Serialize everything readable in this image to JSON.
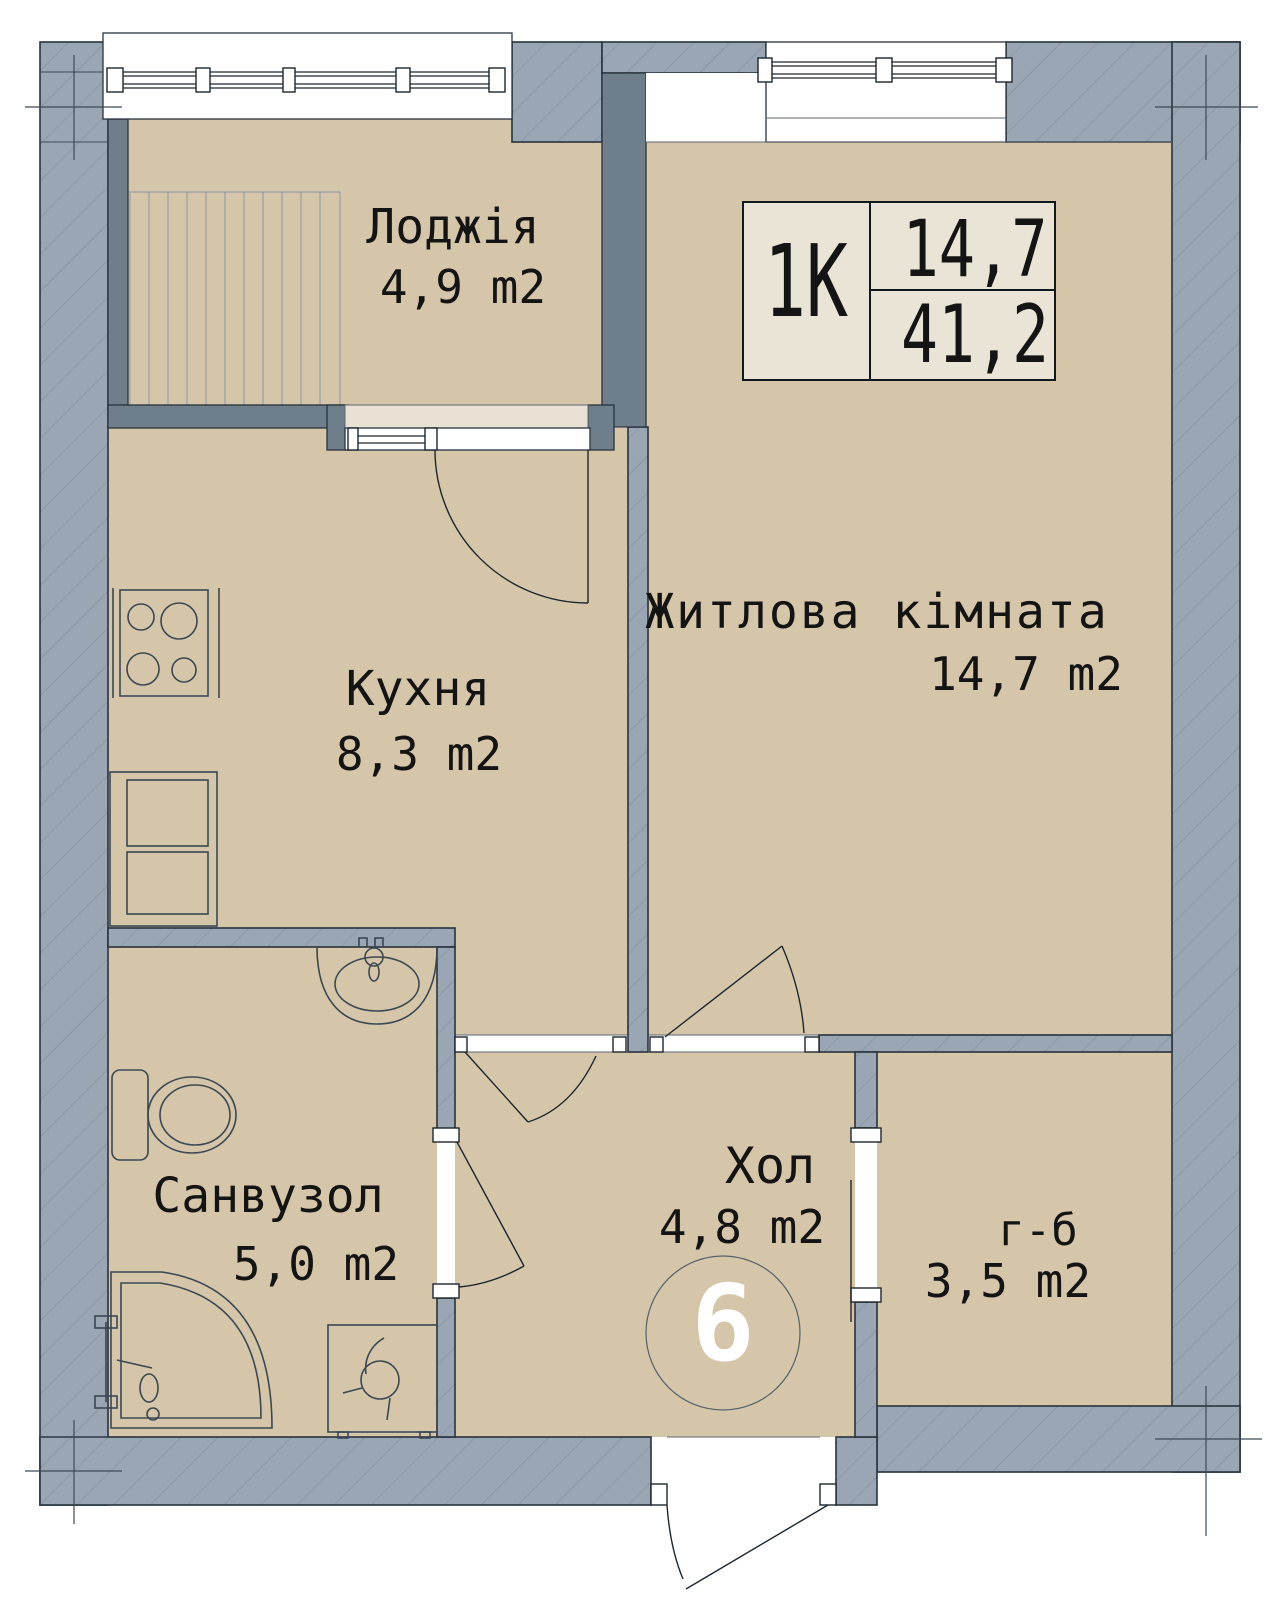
{
  "stamp": {
    "type_label": "1K",
    "living_area_value": "14,7",
    "total_area_value": "41,2"
  },
  "unit_number": "6",
  "rooms": {
    "loggia": {
      "name": "Лоджія",
      "area": "4,9 m2"
    },
    "living_room": {
      "name": "Житлова кімната",
      "area": "14,7 m2"
    },
    "kitchen": {
      "name": "Кухня",
      "area": "8,3 m2"
    },
    "bathroom": {
      "name": "Санвузол",
      "area": "5,0 m2"
    },
    "hall": {
      "name": "Хол",
      "area": "4,8 m2"
    },
    "wardrobe": {
      "name": "г-б",
      "area": "3,5 m2"
    }
  },
  "fixtures": [
    "stove",
    "refrigerator",
    "sink",
    "toilet",
    "corner-shower",
    "washing-machine"
  ],
  "colors": {
    "floor": "#d5c6aa",
    "wall": "#9aa6b3",
    "wall_hatch": "#85919e",
    "wall_dark": "#6f7e8b",
    "windowsill": "#e9e1d3",
    "stamp_bg": "#e9e4d6",
    "line": "#1c262e",
    "text": "#141414",
    "unit_number_text": "#ffffff"
  }
}
